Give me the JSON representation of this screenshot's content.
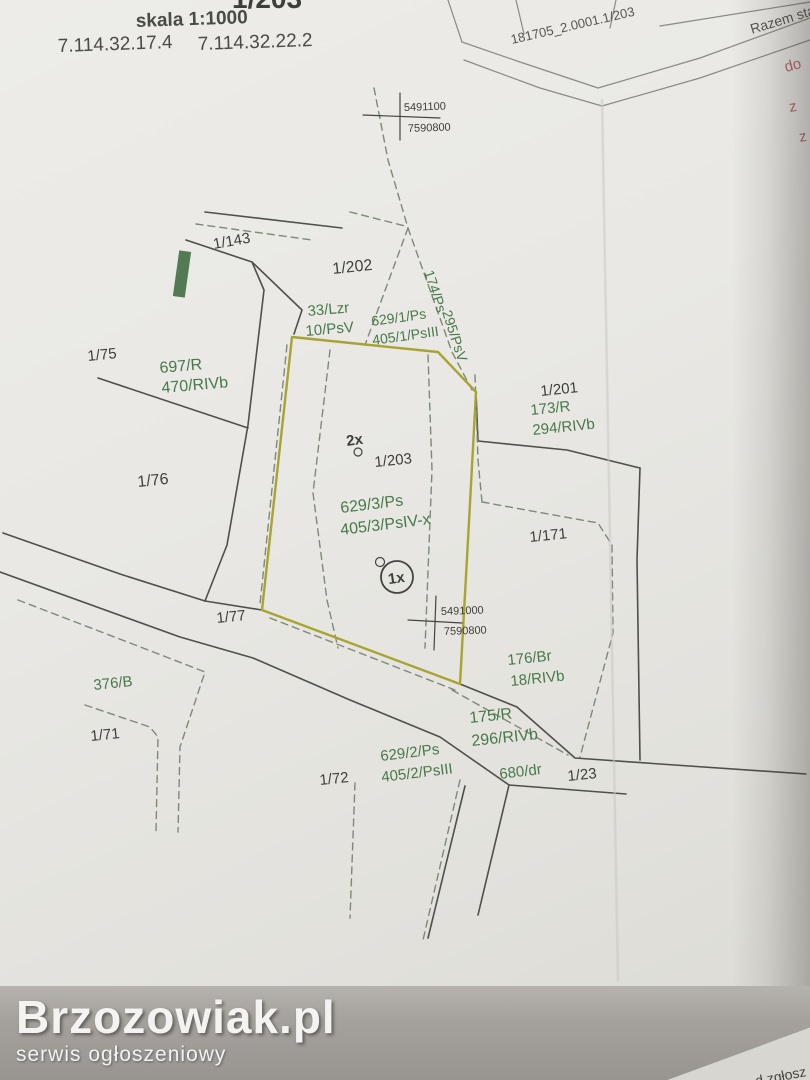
{
  "header": {
    "clipped_title": "1/203",
    "scale_label": "skala 1:1000",
    "ref_number_1": "7.114.32.17.4",
    "ref_number_2": "7.114.32.22.2"
  },
  "folded_sheet": {
    "cell_label": "181705_2.0001.1/203",
    "cell_label_2": "Razem sta",
    "red_notes": [
      "do",
      "z",
      "z"
    ]
  },
  "watermark": {
    "title": "Brzozowiak.pl",
    "subtitle": "serwis ogłoszeniowy"
  },
  "bottom_note": "d zgłosz",
  "text_colors": {
    "dark": "#3f3f3a",
    "green": "#47794a",
    "red": "#c25f68",
    "gray": "#56544f",
    "header": "#4a4a46"
  },
  "styles": {
    "solid": {
      "stroke": "#50504b",
      "width": 1.6
    },
    "dashed": {
      "stroke": "#7d8a76",
      "width": 1.4,
      "dash": "7,5"
    },
    "outline": {
      "stroke": "#a8a432",
      "width": 2.4
    },
    "cross": {
      "stroke": "#45453f",
      "width": 1.2
    },
    "fold": {
      "stroke": "#8d8a84",
      "width": 1.2
    },
    "crease": {
      "stroke": "#cbc9c3",
      "width": 2.5,
      "opacity": 0.55
    }
  },
  "map": {
    "grid_crosses": [
      {
        "northing": "5491100",
        "easting": "7590800"
      },
      {
        "northing": "5491000",
        "easting": "7590800"
      }
    ],
    "lines": {
      "solid": [
        [
          [
            205,
            212
          ],
          [
            342,
            228
          ]
        ],
        [
          [
            186,
            240
          ],
          [
            252,
            262
          ],
          [
            264,
            290
          ],
          [
            248,
            425
          ],
          [
            227,
            545
          ],
          [
            205,
            601
          ]
        ],
        [
          [
            98,
            378
          ],
          [
            248,
            428
          ]
        ],
        [
          [
            252,
            262
          ],
          [
            302,
            310
          ],
          [
            294,
            334
          ]
        ],
        [
          [
            3,
            533
          ],
          [
            120,
            574
          ],
          [
            205,
            601
          ]
        ],
        [
          [
            205,
            601
          ],
          [
            262,
            610
          ]
        ],
        [
          [
            0,
            572
          ],
          [
            180,
            637
          ],
          [
            253,
            658
          ],
          [
            350,
            700
          ],
          [
            440,
            737
          ],
          [
            509,
            785
          ]
        ],
        [
          [
            460,
            684
          ],
          [
            517,
            707
          ],
          [
            575,
            758
          ],
          [
            660,
            764
          ],
          [
            806,
            774
          ]
        ],
        [
          [
            509,
            785
          ],
          [
            626,
            794
          ]
        ],
        [
          [
            465,
            786
          ],
          [
            428,
            938
          ]
        ],
        [
          [
            509,
            785
          ],
          [
            478,
            915
          ]
        ],
        [
          [
            478,
            441
          ],
          [
            567,
            450
          ],
          [
            640,
            468
          ]
        ],
        [
          [
            640,
            468
          ],
          [
            637,
            560
          ],
          [
            640,
            760
          ]
        ],
        [
          [
            476,
            392
          ],
          [
            478,
            441
          ]
        ]
      ],
      "dashed": [
        [
          [
            374,
            88
          ],
          [
            388,
            160
          ],
          [
            408,
            228
          ]
        ],
        [
          [
            408,
            228
          ],
          [
            365,
            345
          ]
        ],
        [
          [
            408,
            228
          ],
          [
            452,
            352
          ],
          [
            472,
            390
          ]
        ],
        [
          [
            350,
            212
          ],
          [
            405,
            226
          ]
        ],
        [
          [
            196,
            224
          ],
          [
            312,
            240
          ]
        ],
        [
          [
            330,
            350
          ],
          [
            313,
            493
          ],
          [
            327,
            600
          ],
          [
            338,
            648
          ]
        ],
        [
          [
            428,
            355
          ],
          [
            432,
            470
          ],
          [
            425,
            648
          ]
        ],
        [
          [
            460,
            780
          ],
          [
            423,
            940
          ]
        ],
        [
          [
            355,
            783
          ],
          [
            350,
            918
          ]
        ],
        [
          [
            475,
            375
          ],
          [
            478,
            460
          ],
          [
            482,
            502
          ]
        ],
        [
          [
            482,
            502
          ],
          [
            598,
            523
          ],
          [
            612,
            545
          ],
          [
            613,
            633
          ],
          [
            580,
            757
          ]
        ],
        [
          [
            18,
            600
          ],
          [
            143,
            648
          ],
          [
            205,
            672
          ],
          [
            180,
            747
          ],
          [
            178,
            832
          ]
        ],
        [
          [
            85,
            705
          ],
          [
            150,
            727
          ],
          [
            158,
            737
          ],
          [
            156,
            832
          ]
        ],
        [
          [
            452,
            690
          ],
          [
            568,
            755
          ]
        ],
        [
          [
            270,
            618
          ],
          [
            455,
            690
          ]
        ],
        [
          [
            287,
            345
          ],
          [
            260,
            604
          ]
        ]
      ],
      "outline": [
        [
          [
            292,
            337
          ],
          [
            438,
            352
          ],
          [
            476,
            392
          ],
          [
            468,
            540
          ],
          [
            460,
            684
          ],
          [
            262,
            610
          ],
          [
            292,
            337
          ]
        ]
      ],
      "cross": [
        [
          [
            363,
            115
          ],
          [
            440,
            118
          ]
        ],
        [
          [
            400,
            93
          ],
          [
            400,
            140
          ]
        ],
        [
          [
            408,
            620
          ],
          [
            462,
            623
          ]
        ],
        [
          [
            436,
            596
          ],
          [
            434,
            650
          ]
        ]
      ],
      "fold": [
        [
          [
            448,
            0
          ],
          [
            462,
            42
          ]
        ],
        [
          [
            462,
            42
          ],
          [
            520,
            62
          ],
          [
            598,
            88
          ],
          [
            700,
            58
          ],
          [
            810,
            18
          ]
        ],
        [
          [
            464,
            60
          ],
          [
            540,
            88
          ],
          [
            602,
            106
          ],
          [
            700,
            78
          ],
          [
            810,
            40
          ]
        ],
        [
          [
            516,
            0
          ],
          [
            524,
            34
          ]
        ],
        [
          [
            616,
            0
          ],
          [
            610,
            28
          ]
        ],
        [
          [
            660,
            26
          ],
          [
            810,
            2
          ]
        ]
      ],
      "crease": [
        [
          [
            602,
            100
          ],
          [
            618,
            980
          ]
        ]
      ]
    },
    "labels": [
      {
        "id": "clipped-title",
        "text": "1/203",
        "x": 232,
        "y": 8,
        "size": 28,
        "color": "dark",
        "rot": 0,
        "bold": true
      },
      {
        "id": "scale",
        "text": "skala 1:1000",
        "x": 136,
        "y": 27,
        "size": 19,
        "color": "header",
        "rot": -2,
        "bold": true
      },
      {
        "id": "ref-1",
        "text": "7.114.32.17.4",
        "x": 58,
        "y": 52,
        "size": 19,
        "color": "header",
        "rot": -2,
        "bold": false
      },
      {
        "id": "ref-2",
        "text": "7.114.32.22.2",
        "x": 198,
        "y": 50,
        "size": 19,
        "color": "header",
        "rot": -2,
        "bold": false
      },
      {
        "id": "sheet-cell",
        "text": "181705_2.0001.1/203",
        "x": 512,
        "y": 44,
        "size": 13,
        "color": "gray",
        "rot": -13,
        "bold": false
      },
      {
        "id": "sheet-cell-2",
        "text": "Razem sta",
        "x": 752,
        "y": 34,
        "size": 14,
        "color": "gray",
        "rot": -17,
        "bold": false
      },
      {
        "id": "red-note-1",
        "text": "do",
        "x": 786,
        "y": 72,
        "size": 15,
        "color": "red",
        "rot": -15,
        "bold": false
      },
      {
        "id": "red-note-2",
        "text": "z",
        "x": 790,
        "y": 112,
        "size": 15,
        "color": "red",
        "rot": -10,
        "bold": false
      },
      {
        "id": "red-note-3",
        "text": "z",
        "x": 800,
        "y": 142,
        "size": 15,
        "color": "red",
        "rot": -10,
        "bold": false
      },
      {
        "id": "cross1-northing",
        "text": "5491100",
        "x": 404,
        "y": 111,
        "size": 11,
        "color": "dark",
        "rot": -2,
        "bold": false
      },
      {
        "id": "cross1-easting",
        "text": "7590800",
        "x": 408,
        "y": 132,
        "size": 11,
        "color": "dark",
        "rot": -2,
        "bold": false
      },
      {
        "id": "cross2-northing",
        "text": "5491000",
        "x": 441,
        "y": 615,
        "size": 11,
        "color": "dark",
        "rot": -2,
        "bold": false
      },
      {
        "id": "cross2-easting",
        "text": "7590800",
        "x": 444,
        "y": 635,
        "size": 11,
        "color": "dark",
        "rot": -2,
        "bold": false
      },
      {
        "id": "parcel-1-143",
        "text": "1/143",
        "x": 214,
        "y": 249,
        "size": 15,
        "color": "dark",
        "rot": -10,
        "bold": false
      },
      {
        "id": "parcel-1-202",
        "text": "1/202",
        "x": 333,
        "y": 274,
        "size": 16,
        "color": "dark",
        "rot": -6,
        "bold": false
      },
      {
        "id": "parcel-1-75",
        "text": "1/75",
        "x": 88,
        "y": 361,
        "size": 15,
        "color": "dark",
        "rot": -6,
        "bold": false
      },
      {
        "id": "parcel-1-76",
        "text": "1/76",
        "x": 138,
        "y": 487,
        "size": 16,
        "color": "dark",
        "rot": -6,
        "bold": false
      },
      {
        "id": "parcel-1-201",
        "text": "1/201",
        "x": 541,
        "y": 396,
        "size": 15,
        "color": "dark",
        "rot": -6,
        "bold": false
      },
      {
        "id": "parcel-1-203",
        "text": "1/203",
        "x": 375,
        "y": 467,
        "size": 15,
        "color": "dark",
        "rot": -6,
        "bold": false
      },
      {
        "id": "parcel-1-171",
        "text": "1/171",
        "x": 530,
        "y": 542,
        "size": 15,
        "color": "dark",
        "rot": -6,
        "bold": false
      },
      {
        "id": "parcel-1-77",
        "text": "1/77",
        "x": 217,
        "y": 623,
        "size": 15,
        "color": "dark",
        "rot": -6,
        "bold": false
      },
      {
        "id": "parcel-1-71",
        "text": "1/71",
        "x": 91,
        "y": 741,
        "size": 15,
        "color": "dark",
        "rot": -6,
        "bold": false
      },
      {
        "id": "parcel-1-72",
        "text": "1/72",
        "x": 320,
        "y": 785,
        "size": 15,
        "color": "dark",
        "rot": -6,
        "bold": false
      },
      {
        "id": "parcel-1-23",
        "text": "1/23",
        "x": 568,
        "y": 781,
        "size": 15,
        "color": "dark",
        "rot": -6,
        "bold": false
      },
      {
        "id": "marker-2x",
        "text": "2x",
        "x": 347,
        "y": 446,
        "size": 15,
        "color": "dark",
        "rot": -8,
        "bold": true
      },
      {
        "id": "marker-1x",
        "text": "1x",
        "x": 397,
        "y": 583,
        "size": 15,
        "color": "dark",
        "rot": -8,
        "bold": true,
        "anchor": "middle"
      },
      {
        "id": "class-33-lzr",
        "text": "33/Lzr",
        "x": 308,
        "y": 316,
        "size": 15,
        "color": "green",
        "rot": -5,
        "bold": false
      },
      {
        "id": "class-10-psv",
        "text": "10/PsV",
        "x": 306,
        "y": 336,
        "size": 15,
        "color": "green",
        "rot": -5,
        "bold": false
      },
      {
        "id": "class-629-1-ps",
        "text": "629/1/Ps",
        "x": 372,
        "y": 326,
        "size": 14,
        "color": "green",
        "rot": -8,
        "bold": false
      },
      {
        "id": "class-405-1-psiii",
        "text": "405/1/PsIII",
        "x": 373,
        "y": 345,
        "size": 14,
        "color": "green",
        "rot": -8,
        "bold": false
      },
      {
        "id": "class-174-ps",
        "text": "174/Ps",
        "x": 424,
        "y": 272,
        "size": 14,
        "color": "green",
        "rot": 72,
        "bold": false
      },
      {
        "id": "class-295-psv",
        "text": "295/PsV",
        "x": 442,
        "y": 312,
        "size": 14,
        "color": "green",
        "rot": 72,
        "bold": false
      },
      {
        "id": "class-697-r",
        "text": "697/R",
        "x": 160,
        "y": 373,
        "size": 16,
        "color": "green",
        "rot": -5,
        "bold": false
      },
      {
        "id": "class-470-rivb",
        "text": "470/RIVb",
        "x": 162,
        "y": 393,
        "size": 16,
        "color": "green",
        "rot": -5,
        "bold": false
      },
      {
        "id": "class-173-r",
        "text": "173/R",
        "x": 531,
        "y": 415,
        "size": 15,
        "color": "green",
        "rot": -6,
        "bold": false
      },
      {
        "id": "class-294-rivb",
        "text": "294/RIVb",
        "x": 533,
        "y": 435,
        "size": 15,
        "color": "green",
        "rot": -6,
        "bold": false
      },
      {
        "id": "class-629-3-ps",
        "text": "629/3/Ps",
        "x": 341,
        "y": 513,
        "size": 16,
        "color": "green",
        "rot": -7,
        "bold": false
      },
      {
        "id": "class-405-3-psiv",
        "text": "405/3/PsIV-x",
        "x": 341,
        "y": 535,
        "size": 16,
        "color": "green",
        "rot": -7,
        "bold": false
      },
      {
        "id": "class-176-br",
        "text": "176/Br",
        "x": 508,
        "y": 665,
        "size": 15,
        "color": "green",
        "rot": -6,
        "bold": false
      },
      {
        "id": "class-18-rivb",
        "text": "18/RIVb",
        "x": 511,
        "y": 686,
        "size": 15,
        "color": "green",
        "rot": -6,
        "bold": false
      },
      {
        "id": "class-175-r",
        "text": "175/R",
        "x": 470,
        "y": 723,
        "size": 16,
        "color": "green",
        "rot": -6,
        "bold": false
      },
      {
        "id": "class-296-rivb",
        "text": "296/RIVb",
        "x": 472,
        "y": 746,
        "size": 16,
        "color": "green",
        "rot": -6,
        "bold": false
      },
      {
        "id": "class-629-2-ps",
        "text": "629/2/Ps",
        "x": 381,
        "y": 761,
        "size": 15,
        "color": "green",
        "rot": -7,
        "bold": false
      },
      {
        "id": "class-405-2-psiii",
        "text": "405/2/PsIII",
        "x": 382,
        "y": 782,
        "size": 15,
        "color": "green",
        "rot": -7,
        "bold": false
      },
      {
        "id": "class-680-dr",
        "text": "680/dr",
        "x": 500,
        "y": 779,
        "size": 15,
        "color": "green",
        "rot": -7,
        "bold": false
      },
      {
        "id": "class-376-b",
        "text": "376/B",
        "x": 94,
        "y": 690,
        "size": 15,
        "color": "green",
        "rot": -6,
        "bold": false
      }
    ],
    "circles": [
      {
        "id": "point-circle-1x",
        "cx": 397,
        "cy": 577,
        "r": 16,
        "width": 1.8
      },
      {
        "id": "point-dot-1x",
        "cx": 380,
        "cy": 562,
        "r": 4.5,
        "width": 1.2
      },
      {
        "id": "point-dot-2x",
        "cx": 358,
        "cy": 452,
        "r": 4,
        "width": 1.2
      }
    ],
    "green_mark": {
      "x": 176,
      "y": 251,
      "w": 12,
      "h": 46,
      "rot": 8,
      "fill": "#3c6b40"
    }
  }
}
